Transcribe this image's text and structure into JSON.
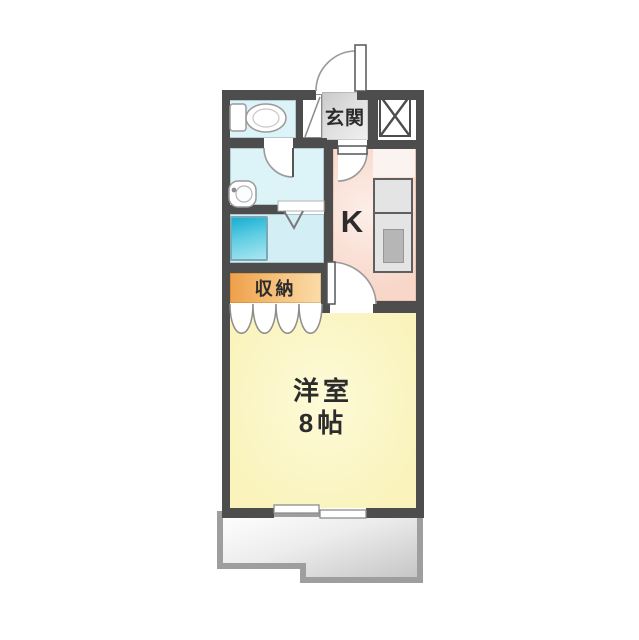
{
  "plan": {
    "kind": "japanese-apartment-floor-plan",
    "labels": {
      "entrance": "玄関",
      "kitchen": "K",
      "storage": "収納",
      "main_room_name": "洋室",
      "main_room_size": "8帖"
    },
    "colors": {
      "wall": "#4d4d4d",
      "text": "#2c2c2c",
      "sanitary_floor": "#dcf4f8",
      "bath_floor": "#d3eff5",
      "kitchen_floor": "#f8d7c9",
      "kitchen_floor_light": "#fdeee8",
      "living_floor": "#faf3bc",
      "living_floor_light": "#fdfad8",
      "storage_dark": "#efa04a",
      "storage_light": "#fadca9",
      "genkan_dark": "#c9c9c9",
      "genkan_light": "#f0f0f0",
      "tub_dark": "#17aed2",
      "tub_light": "#aae6f1",
      "counter": "#e4e4e4",
      "sink": "#b6b6b6",
      "balcony_edge": "#9e9e9e",
      "balcony_dark": "#c4c4c4",
      "fixture_outline": "#9a9a9a",
      "door_leaf": "#555555"
    }
  }
}
